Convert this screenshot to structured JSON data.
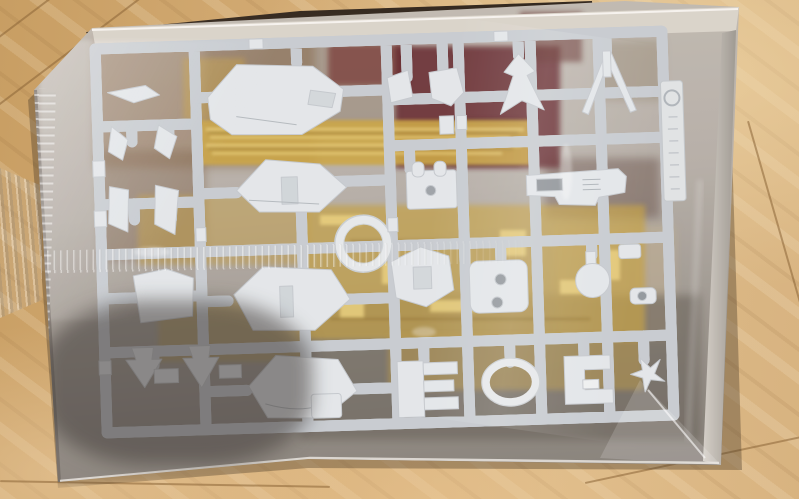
{
  "meta": {
    "type": "photograph",
    "domain_note": "Natural image: no UI widgets and no legible text anywhere in the frame",
    "alt": "Top-down photo of an opened plastic model kit box resting on a light wooden floor. A large white injection-molded parts runner (sprue) filled with mecha armor pieces is sealed inside a glossy clear plastic bag. Gold-plated and dark red runners show through from underneath, and a molded runner ID tag with a circular logo sits along the right edge of the sprue."
  },
  "scene": {
    "floor": {
      "label": "light wooden floor with diagonal grain and plank seams",
      "base_color": "#d4ac75"
    },
    "box": {
      "label": "kit box interior with pale cardboard rim",
      "rim_color": "#d9d3c9"
    },
    "bag": {
      "label": "clear glossy plastic bag with crinkled seams, folds and white highlights"
    },
    "white_runner": {
      "label": "white parts runner (sprue) with molded armor pieces",
      "plastic_color": "#e7eaec",
      "parts": [
        "large chest armor plate",
        "mid chest armor plate",
        "waist armor plate",
        "curved skirt armor plate",
        "circular ring joint",
        "v-fin antenna",
        "winged thruster piece",
        "beam rifle body",
        "backpack block",
        "knee armor piece",
        "two-hole side plate",
        "oval ring frame",
        "comb-shaped vent plate",
        "round knob joint",
        "C-shaped bracket",
        "star-shaped joint",
        "assorted small wings, brackets and tabs"
      ]
    },
    "gold_runner": {
      "label": "gold-plated runner visible underneath",
      "color": "#c9a23d"
    },
    "red_runner": {
      "label": "dark red parts visible underneath",
      "color": "#5c1f20"
    },
    "runner_tag": {
      "label": "molded runner ID tag with circular maker logo, embossed text not legible"
    }
  },
  "lighting": {
    "highlight_color": "#ffffff",
    "shadow_color": "#3e3a36"
  }
}
